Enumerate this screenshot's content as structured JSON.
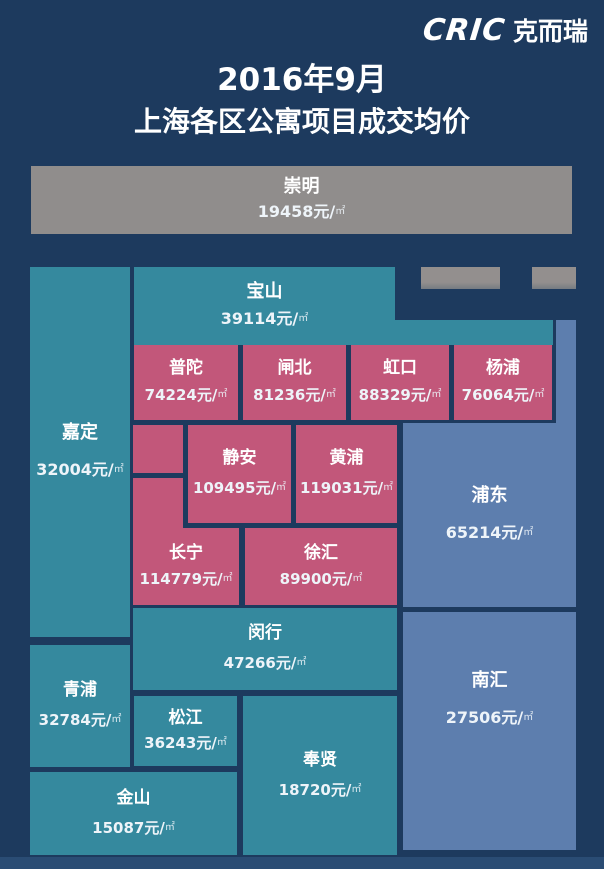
{
  "logo": {
    "latin": "CRIC",
    "cjk": "克而瑞"
  },
  "title": {
    "line1": "2016年9月",
    "line2": "上海各区公寓项目成交均价"
  },
  "units": {
    "yuan": "元/",
    "sq": "㎡"
  },
  "districts": {
    "chongming": {
      "name": "崇明",
      "value": "19458"
    },
    "baoshan": {
      "name": "宝山",
      "value": "39114"
    },
    "jiading": {
      "name": "嘉定",
      "value": "32004"
    },
    "putuo": {
      "name": "普陀",
      "value": "74224"
    },
    "zhabei": {
      "name": "闸北",
      "value": "81236"
    },
    "hongkou": {
      "name": "虹口",
      "value": "88329"
    },
    "yangpu": {
      "name": "杨浦",
      "value": "76064"
    },
    "jingan": {
      "name": "静安",
      "value": "109495"
    },
    "huangpu": {
      "name": "黄浦",
      "value": "119031"
    },
    "changning": {
      "name": "长宁",
      "value": "114779"
    },
    "xuhui": {
      "name": "徐汇",
      "value": "89900"
    },
    "pudong": {
      "name": "浦东",
      "value": "65214"
    },
    "minhang": {
      "name": "闵行",
      "value": "47266"
    },
    "qingpu": {
      "name": "青浦",
      "value": "32784"
    },
    "songjiang": {
      "name": "松江",
      "value": "36243"
    },
    "fengxian": {
      "name": "奉贤",
      "value": "18720"
    },
    "nanhui": {
      "name": "南汇",
      "value": "27506"
    },
    "jinshan": {
      "name": "金山",
      "value": "15087"
    }
  },
  "colors": {
    "background": "#1d3a5e",
    "teal": "#35899e",
    "pink": "#c2577a",
    "light_blue": "#5d7eae",
    "gray": "#908d8c",
    "text": "#ffffff"
  },
  "chart_data": {
    "type": "treemap",
    "title": "2016年9月 上海各区公寓项目成交均价",
    "unit": "元/㎡",
    "legend_position": "none",
    "data": [
      {
        "district": "崇明",
        "price": 19458,
        "color": "#908d8c"
      },
      {
        "district": "宝山",
        "price": 39114,
        "color": "#35899e"
      },
      {
        "district": "嘉定",
        "price": 32004,
        "color": "#35899e"
      },
      {
        "district": "普陀",
        "price": 74224,
        "color": "#c2577a"
      },
      {
        "district": "闸北",
        "price": 81236,
        "color": "#c2577a"
      },
      {
        "district": "虹口",
        "price": 88329,
        "color": "#c2577a"
      },
      {
        "district": "杨浦",
        "price": 76064,
        "color": "#c2577a"
      },
      {
        "district": "静安",
        "price": 109495,
        "color": "#c2577a"
      },
      {
        "district": "黄浦",
        "price": 119031,
        "color": "#c2577a"
      },
      {
        "district": "长宁",
        "price": 114779,
        "color": "#c2577a"
      },
      {
        "district": "徐汇",
        "price": 89900,
        "color": "#c2577a"
      },
      {
        "district": "浦东",
        "price": 65214,
        "color": "#5d7eae"
      },
      {
        "district": "闵行",
        "price": 47266,
        "color": "#35899e"
      },
      {
        "district": "青浦",
        "price": 32784,
        "color": "#35899e"
      },
      {
        "district": "松江",
        "price": 36243,
        "color": "#35899e"
      },
      {
        "district": "奉贤",
        "price": 18720,
        "color": "#35899e"
      },
      {
        "district": "南汇",
        "price": 27506,
        "color": "#5d7eae"
      },
      {
        "district": "金山",
        "price": 15087,
        "color": "#35899e"
      }
    ]
  }
}
